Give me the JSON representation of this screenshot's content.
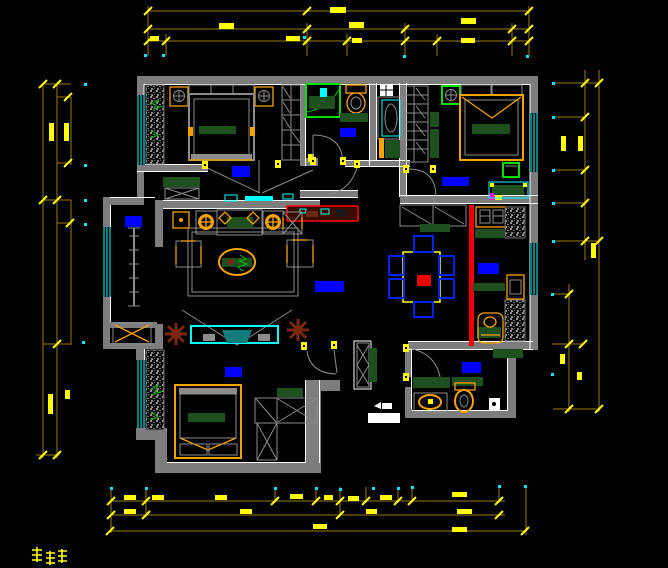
{
  "document": {
    "type": "CAD apartment floor plan drawing",
    "canvas_width": 668,
    "canvas_height": 568,
    "background": "#000000"
  },
  "colors": {
    "walls": "#7d7d7d",
    "wall_edge": "#ffffff",
    "dimension_lines": "#9a7b00",
    "dimension_marks": "#ffff00",
    "reference_dots": "#00e5ff",
    "room_labels": "#0000ff",
    "furniture_wood": "#f5a300",
    "furniture_tops": "#1e4f1e",
    "glass_windows": "#00ffff",
    "fixture_green": "#00dd00",
    "accent_red": "#ee0000",
    "plant_brown": "#7a2710",
    "tv_teal": "#0b7d7d",
    "magenta_mark": "#ff00ff"
  },
  "rooms": [
    {
      "id": "bedroom-top-left",
      "label_color": "#0000ff",
      "furniture": [
        "double-bed",
        "nightstand-left",
        "nightstand-right",
        "hatched-closet",
        "shelf-wardrobe",
        "sideboard",
        "x-frame-console",
        "sliding-glass-door"
      ]
    },
    {
      "id": "bathroom-top",
      "label_color": "#0000ff",
      "furniture": [
        "shower-enclosure",
        "toilet",
        "wash-basin-cabinet",
        "floor-mat",
        "swing-door"
      ]
    },
    {
      "id": "bedroom-top-right",
      "label_color": "#0000ff",
      "furniture": [
        "double-bed",
        "green-nightstand",
        "shelved-wardrobe",
        "desk",
        "chair",
        "swing-door"
      ]
    },
    {
      "id": "living-room",
      "label_color": "#0000ff",
      "furniture": [
        "sofa",
        "lamp-side-tables",
        "armchairs",
        "oval-coffee-table",
        "rug",
        "tv-cabinet",
        "tv",
        "plants",
        "red-console"
      ]
    },
    {
      "id": "balcony",
      "label_color": "#0000ff",
      "furniture": [
        "washing-machine-cabinet",
        "plant-rack"
      ]
    },
    {
      "id": "dining-room",
      "furniture": [
        "dining-table",
        "six-blue-chairs",
        "shoe-cabinet",
        "red-slide-track"
      ]
    },
    {
      "id": "kitchen",
      "label_color": "#0000ff",
      "furniture": [
        "double-sink-counter",
        "refrigerator",
        "stove",
        "counters"
      ]
    },
    {
      "id": "entry-hall",
      "label_color": "#0000ff",
      "furniture": [
        "tall-x-cabinet",
        "shoe-bench",
        "entry-threshold"
      ]
    },
    {
      "id": "bathroom-bottom",
      "furniture": [
        "toilet",
        "wash-basin",
        "floor-drain"
      ]
    },
    {
      "id": "bedroom-bottom-left",
      "label_color": "#0000ff",
      "furniture": [
        "double-bed-with-drawers",
        "hatched-closet",
        "corner-wardrobe"
      ]
    }
  ],
  "dimensions": {
    "top_rows": 3,
    "bottom_rows": 3,
    "left_columns": 3,
    "right_columns": 2,
    "line_color": "#9a7b00",
    "text_color": "#ffff00",
    "note": "dimension figures rendered at sub-legible size in source image"
  }
}
